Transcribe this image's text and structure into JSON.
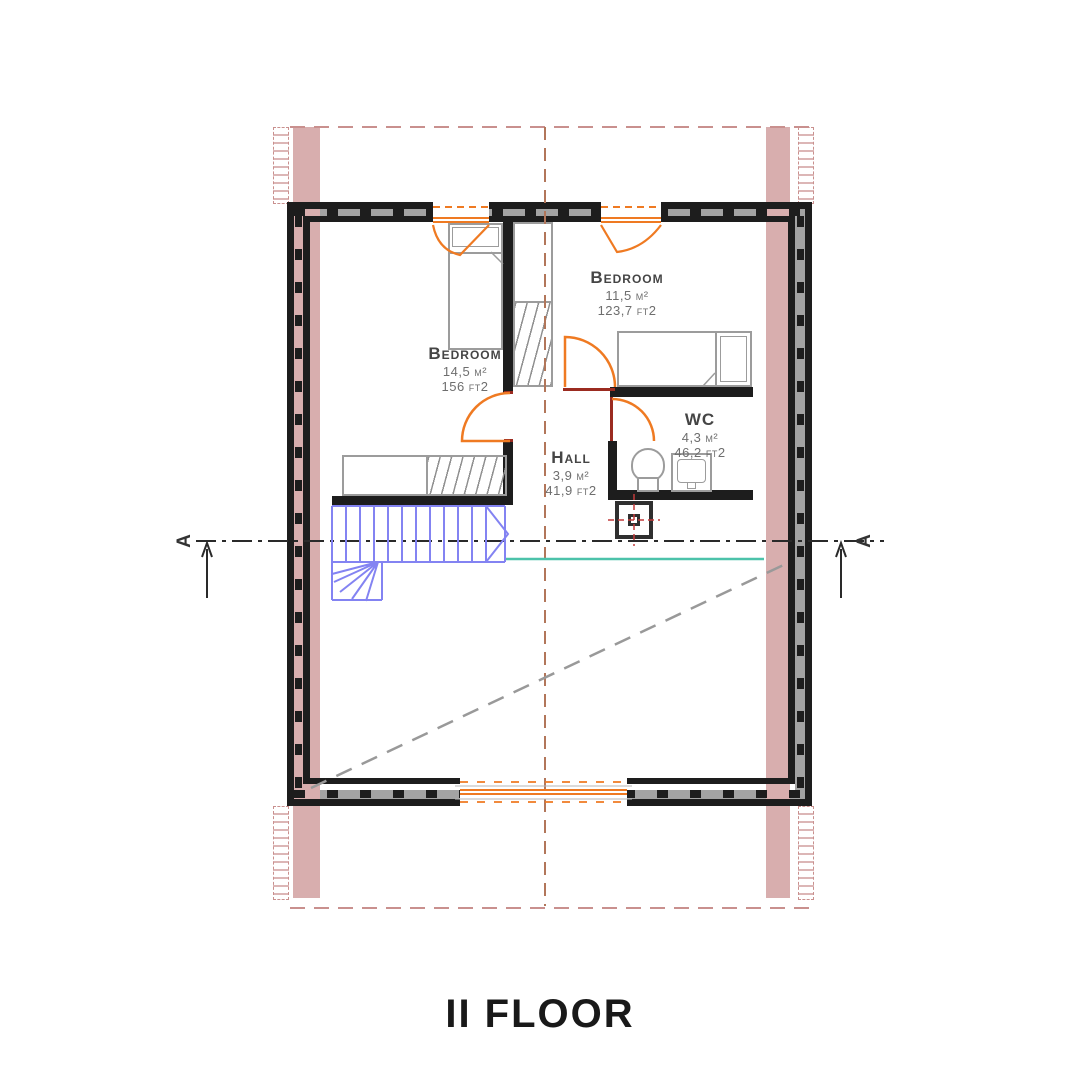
{
  "title": "II FLOOR",
  "section": {
    "left": "A",
    "right": "A"
  },
  "rooms": [
    {
      "name": "Bedroom",
      "area_m2": "14,5 м²",
      "area_ft2": "156 ft2"
    },
    {
      "name": "Bedroom",
      "area_m2": "11,5 м²",
      "area_ft2": "123,7 ft2"
    },
    {
      "name": "WC",
      "area_m2": "4,3 м²",
      "area_ft2": "46,2 ft2"
    },
    {
      "name": "Hall",
      "area_m2": "3,9 м²",
      "area_ft2": "41,9 ft2"
    }
  ],
  "colors": {
    "wall_black": "#1d1d1d",
    "wall_fill_gray": "#a3a3a3",
    "masonry_pink": "#d8aeae",
    "accent_orange": "#ef7a22",
    "stairs_blue": "#8383f2",
    "stair_opening_teal": "#4cc2aa",
    "door_jamb_red": "#9b2b20",
    "centerline_brown": "#b2765a",
    "dashed_pink": "#c9908e",
    "roof_dash_gray": "#999999"
  }
}
